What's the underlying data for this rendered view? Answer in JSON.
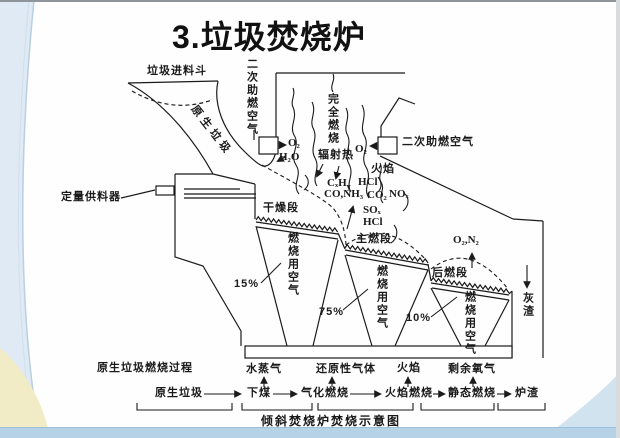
{
  "slide": {
    "title": "3.垃圾焚烧炉",
    "caption": "倾斜焚烧炉焚烧示意图"
  },
  "incinerator": {
    "hopper_label": "垃圾进料斗",
    "raw_waste_label": "原生垃圾",
    "feeder_label": "定量供料器",
    "secondary_air_label": "二次助燃空气",
    "complete_combustion_label": "完全燃烧",
    "radiant_heat_label": "辐射热",
    "flame_label": "火焰",
    "sections": {
      "drying": "干燥段",
      "main": "主燃段",
      "post": "后燃段"
    },
    "combustion_air_label": "燃烧用空气",
    "air_percent": {
      "drying": "15%",
      "main": "75%",
      "post": "10%"
    },
    "ash_label": "灰渣",
    "species": {
      "o2": "O₂",
      "h2o": "H₂O",
      "cxhy_base": "CₓH",
      "cxhy_sub": "y",
      "co_nh3": "CO,NH₃",
      "co2": "CO₂",
      "nox": "NOₓ",
      "sox": "SOₓ",
      "hcl": "HCl",
      "o2_n2": "O₂,N₂"
    }
  },
  "flow": {
    "process_label": "原生垃圾燃烧过程",
    "stages": [
      "原生垃圾",
      "下煤",
      "气化燃烧",
      "火焰燃烧",
      "静态燃烧",
      "炉渣"
    ],
    "emissions": [
      "水蒸气",
      "还原性气体",
      "火焰",
      "剩余氧气"
    ]
  }
}
